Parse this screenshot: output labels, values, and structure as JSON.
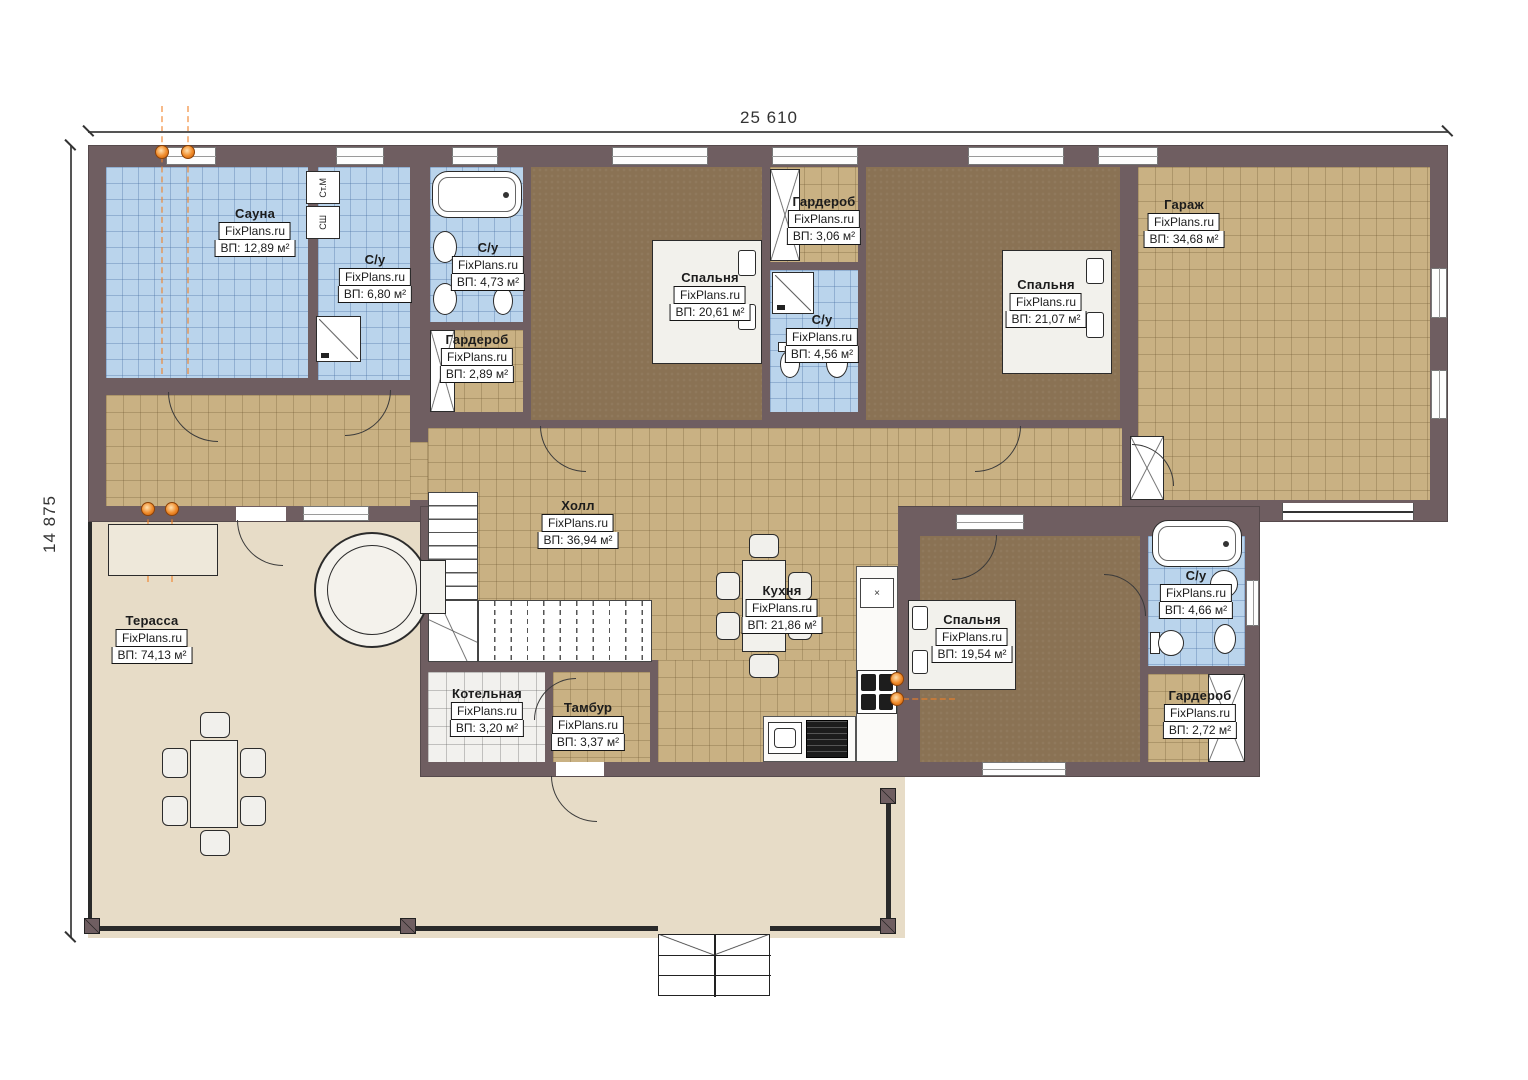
{
  "meta": {
    "brand": "FixPlans.ru",
    "plan_type": "floor-plan"
  },
  "dimensions": {
    "width_label": "25 610",
    "height_label": "14 875"
  },
  "rooms": [
    {
      "name": "Сауна",
      "area_text": "ВП: 12,89 м²"
    },
    {
      "name": "С/у",
      "area_text": "ВП: 6,80 м²"
    },
    {
      "name": "С/у",
      "area_text": "ВП: 4,73 м²"
    },
    {
      "name": "Гардероб",
      "area_text": "ВП: 2,89 м²"
    },
    {
      "name": "Спальня",
      "area_text": "ВП: 20,61 м²"
    },
    {
      "name": "Гардероб",
      "area_text": "ВП: 3,06 м²"
    },
    {
      "name": "С/у",
      "area_text": "ВП: 4,56 м²"
    },
    {
      "name": "Спальня",
      "area_text": "ВП: 21,07 м²"
    },
    {
      "name": "Гараж",
      "area_text": "ВП: 34,68 м²"
    },
    {
      "name": "Холл",
      "area_text": "ВП: 36,94 м²"
    },
    {
      "name": "Кухня",
      "area_text": "ВП: 21,86 м²"
    },
    {
      "name": "Спальня",
      "area_text": "ВП: 19,54 м²"
    },
    {
      "name": "С/у",
      "area_text": "ВП: 4,66 м²"
    },
    {
      "name": "Гардероб",
      "area_text": "ВП: 2,72 м²"
    },
    {
      "name": "Котельная",
      "area_text": "ВП: 3,20 м²"
    },
    {
      "name": "Тамбур",
      "area_text": "ВП: 3,37 м²"
    },
    {
      "name": "Терасса",
      "area_text": "ВП: 74,13 м²"
    }
  ],
  "appliances": {
    "washer": "Ст.М",
    "dryer": "СШ"
  },
  "colors": {
    "wall": "#6f5e61",
    "tile_blue": "#bad4ec",
    "floor_tan": "#c9b183",
    "floor_bedroom": "#8a7254",
    "terrace": "#e7dcc7",
    "boiler_tile": "#f2f1ee",
    "accent_orange": "#f08a28"
  }
}
